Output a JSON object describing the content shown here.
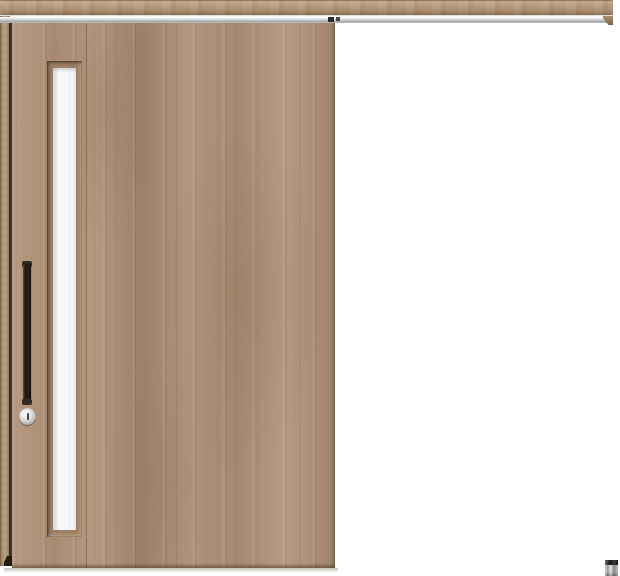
{
  "product": {
    "name": "top-hung-sliding-door",
    "description": "Light walnut wood-grain single sliding door with a vertical slit window, black vertical bar handle, round thumb-turn lock, full-width wooden hanger rail with metal track, and a small floor guide at the lower right."
  },
  "colors": {
    "background": "#ffffff",
    "wood_base": "#ab8f77",
    "wood_light": "#b89d84",
    "wood_dark": "#9d8166",
    "rail_face": "#b79c7e",
    "track_metal": "#e9eaea",
    "track_shadow": "#9ba0a3",
    "glass": "#f4f5f6",
    "handle": "#1a1410",
    "lock_ring": "#b2b2b0",
    "floor_guide_body": "#e5e5e5",
    "floor_guide_cap": "#161616"
  },
  "parts": [
    "hanger-rail-fascia",
    "rail-end-cap",
    "metal-track",
    "track-stoppers",
    "left-jamb",
    "door-panel",
    "glass-slit-window",
    "vertical-bar-handle",
    "thumb-turn-lock",
    "floor-guide"
  ]
}
